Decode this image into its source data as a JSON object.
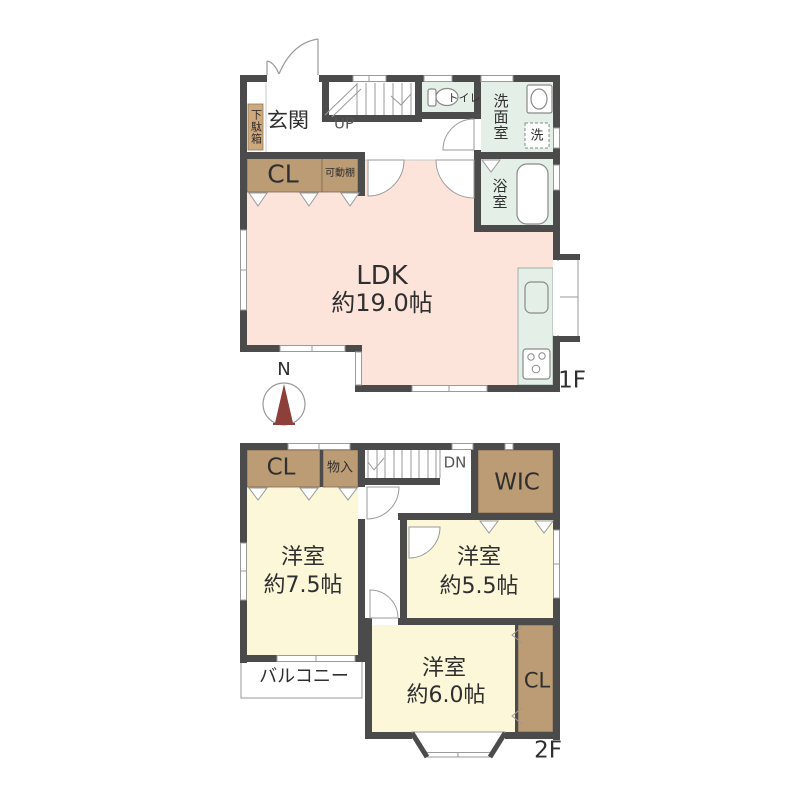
{
  "floor1": {
    "floor_label": "1F",
    "compass_label": "N",
    "entrance": "玄関",
    "shoe_box": "下駄箱",
    "stairs_up": "UP",
    "toilet": "トイレ",
    "washroom": "洗面室",
    "washer": "洗",
    "bathroom": "浴室",
    "closet": "CL",
    "movable_shelf": "可動棚",
    "ldk": {
      "name": "LDK",
      "size": "約19.0帖"
    }
  },
  "floor2": {
    "floor_label": "2F",
    "closet_left": "CL",
    "storage": "物入",
    "stairs_down": "DN",
    "wic": "WIC",
    "bedroom1": {
      "name": "洋室",
      "size": "約7.5帖"
    },
    "bedroom2": {
      "name": "洋室",
      "size": "約5.5帖"
    },
    "bedroom3": {
      "name": "洋室",
      "size": "約6.0帖"
    },
    "closet_right": "CL",
    "balcony": "バルコニー"
  },
  "colors": {
    "wall": "#4b4b4b",
    "ldk_fill": "#fce4da",
    "bedroom_fill": "#fbf7d8",
    "wet_area_fill": "#e3efe7",
    "closet_fill": "#bc9c74",
    "compass_needle": "#8c4039"
  }
}
